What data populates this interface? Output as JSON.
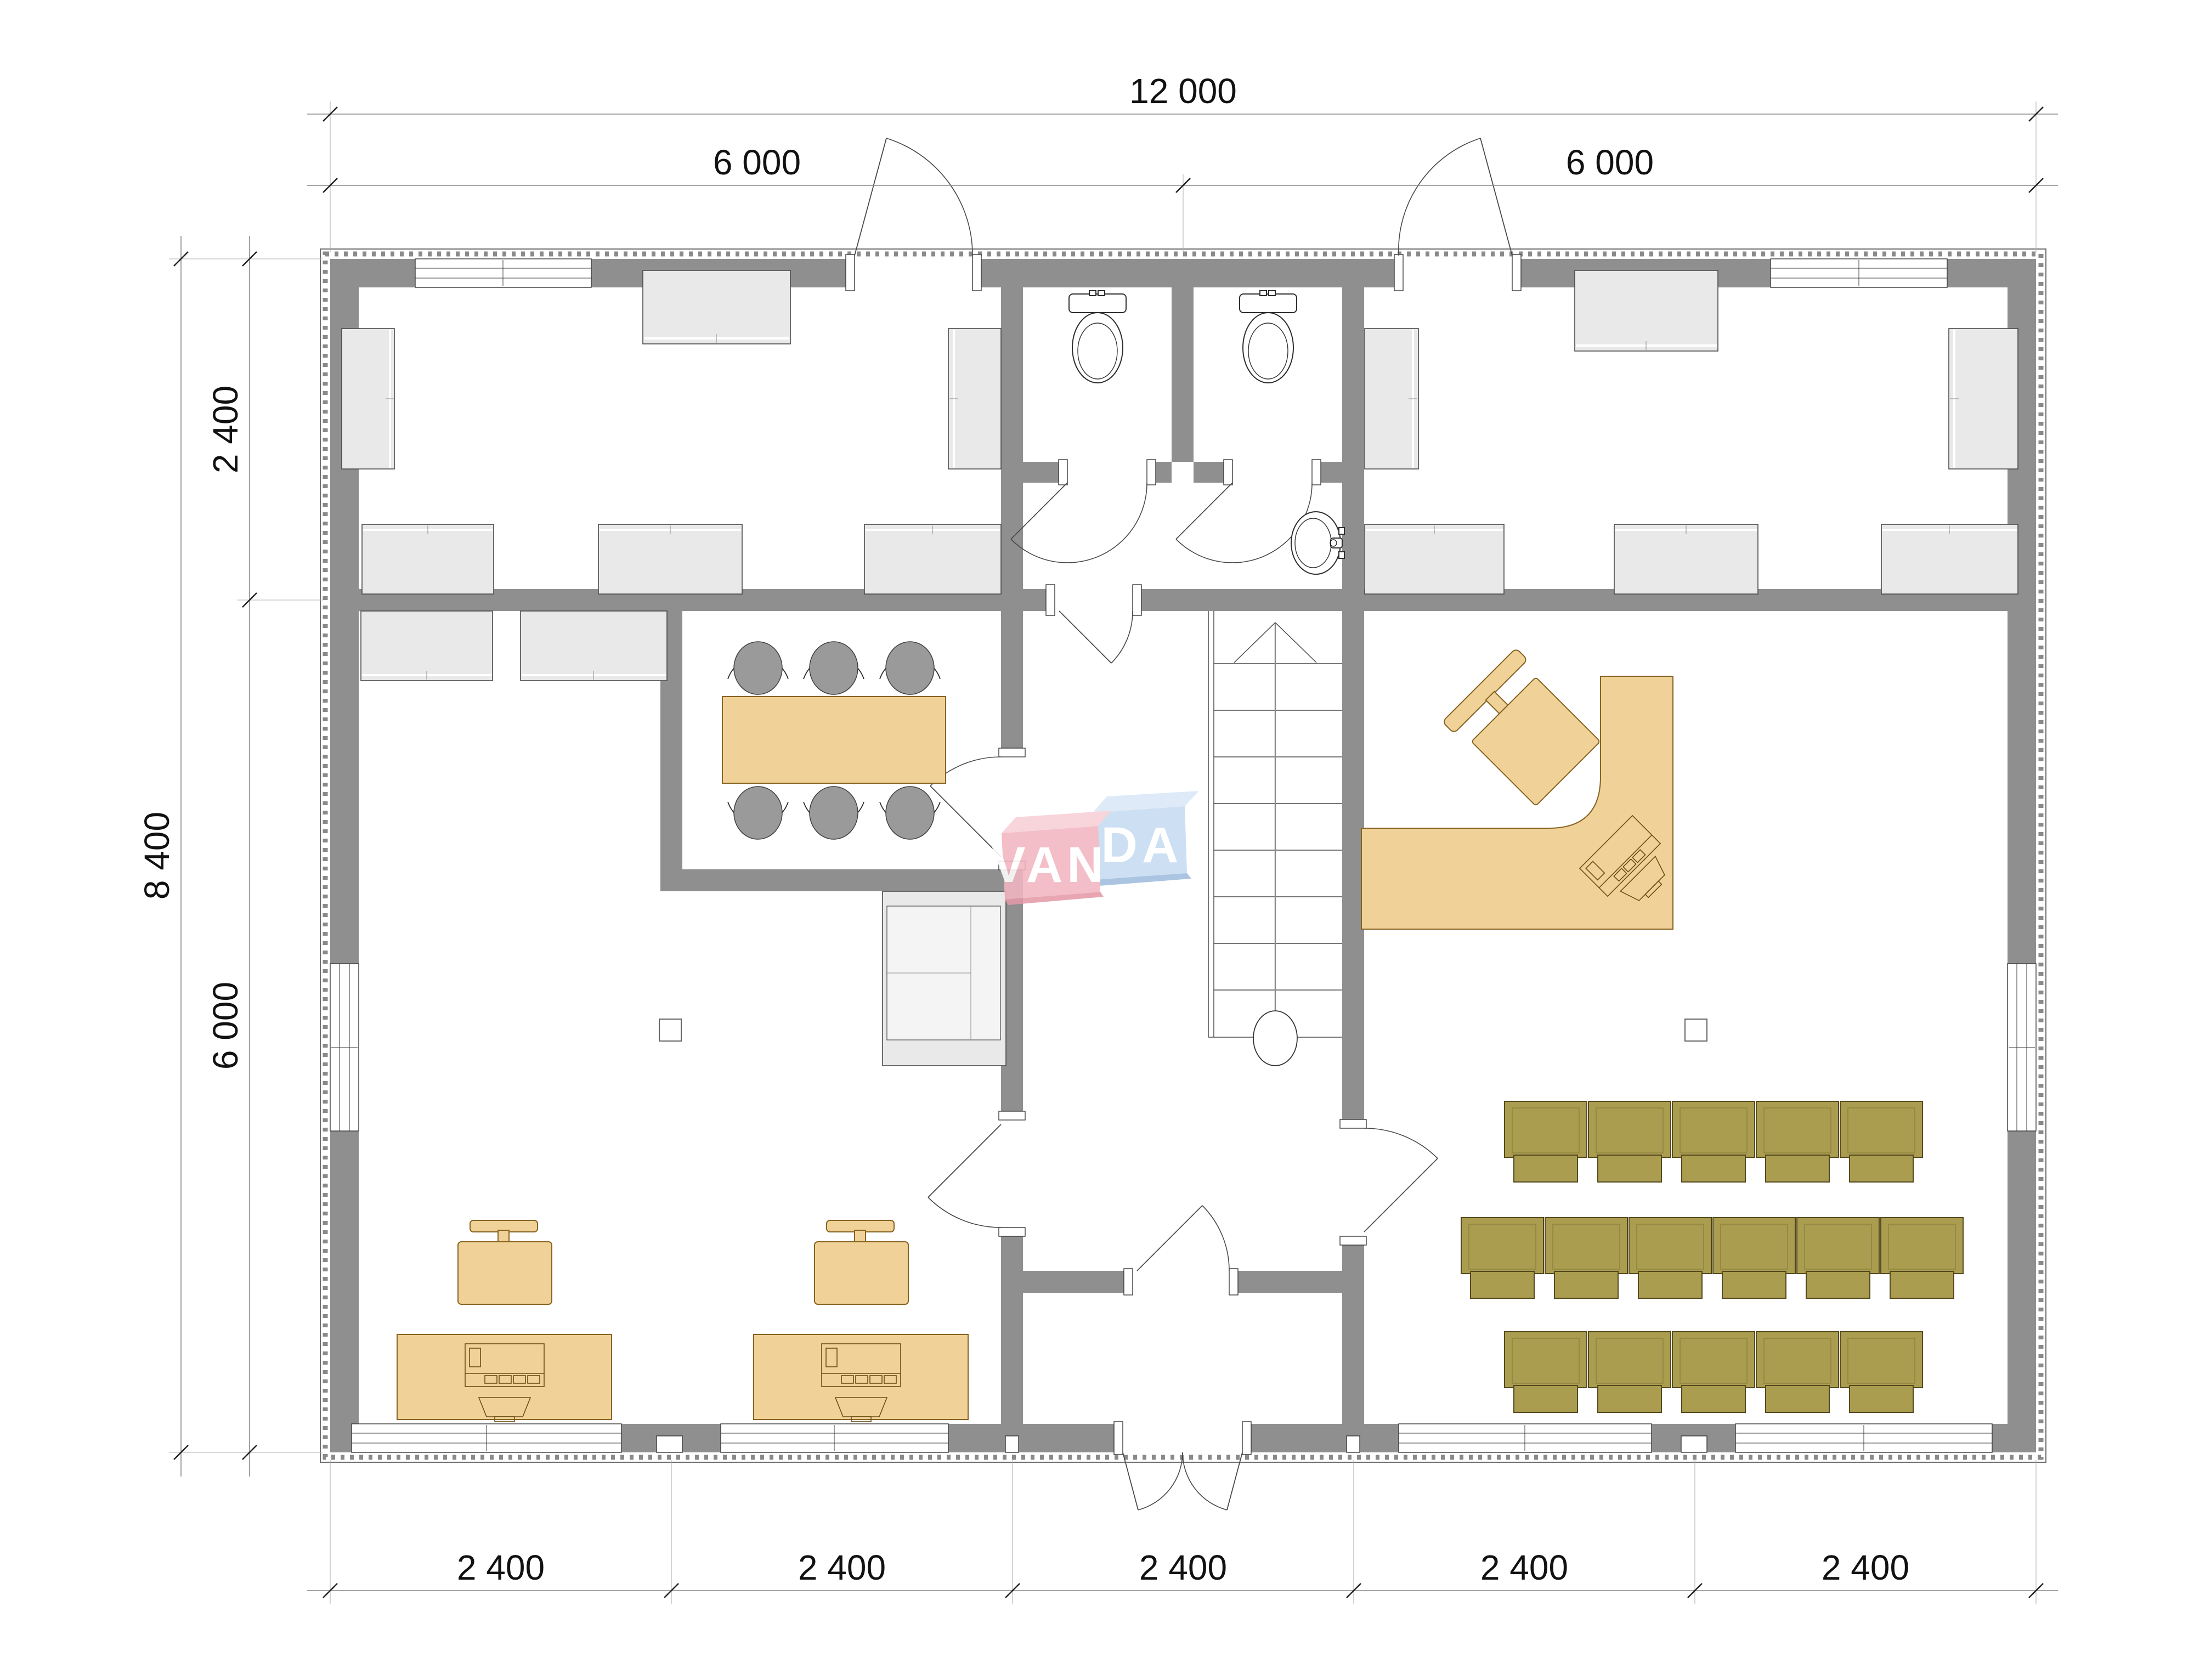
{
  "drawing": {
    "type": "architectural-floor-plan",
    "watermark": {
      "full": "VANDA",
      "part_left": "VAN",
      "part_right": "DA"
    }
  },
  "dimensions": {
    "top_total": "12 000",
    "top_halves": [
      "6 000",
      "6 000"
    ],
    "left_total": "8 400",
    "left_segments": [
      "2 400",
      "6 000"
    ],
    "bottom_segments": [
      "2 400",
      "2 400",
      "2 400",
      "2 400",
      "2 400"
    ]
  },
  "fixtures": {
    "toilets": 2,
    "wash_basin": 1,
    "meeting_table": 1,
    "meeting_chairs": 6,
    "workstation_desks": 2,
    "desk_chairs": 2,
    "reception_desk": 1,
    "reception_chair": 1,
    "theater_seat_rows": [
      5,
      6,
      5
    ],
    "stairs": 1,
    "wall_cabinets": 13
  },
  "colors": {
    "wall_gray": "#8f8f8f",
    "cabinet_gray": "#e9e9e9",
    "cabinet_outline": "#4a4a4a",
    "furniture_tan": "#f0d298",
    "furniture_tan_outline": "#876322",
    "seat_olive": "#aa9d4f",
    "seat_olive_outline": "#55491f",
    "chair_gray": "#9a9a9a",
    "logo_pink": "#f2b6c0",
    "logo_pink_top": "#f8d0d6",
    "logo_pink_side": "#e59aa8",
    "logo_blue": "#c7dbf1",
    "logo_blue_top": "#dbe8f8",
    "logo_blue_side": "#9fbcdf",
    "dim_text": "#111111"
  }
}
